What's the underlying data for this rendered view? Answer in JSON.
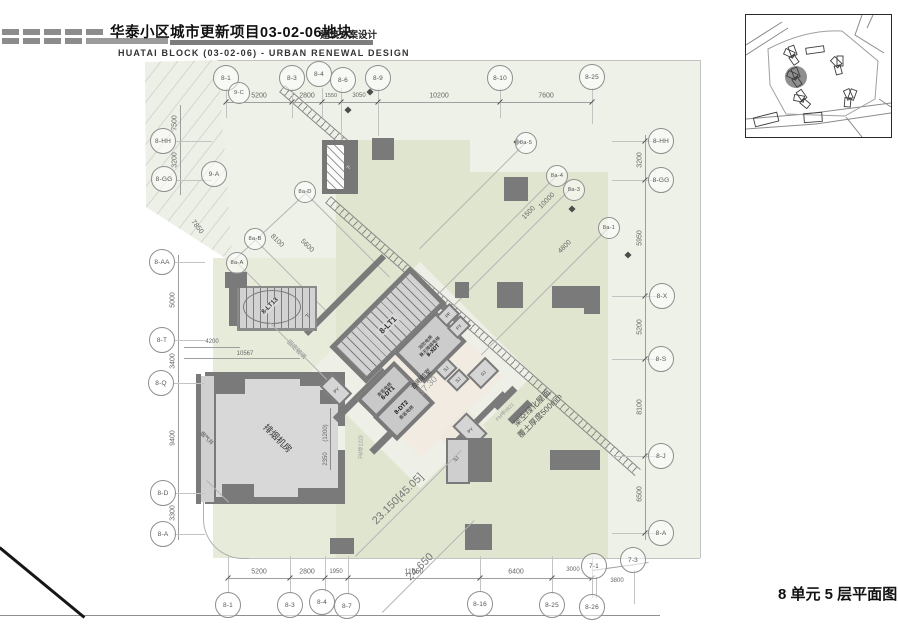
{
  "header": {
    "title": "华泰小区城市更新项目03-02-06地块",
    "subtitle": "建筑方案设计",
    "title_en": "HUATAI BLOCK (03-02-06) - URBAN RENEWAL DESIGN"
  },
  "caption": "8 单元 5 层平面图",
  "colors": {
    "site": "#eef1e7",
    "green_roof": "#dfe5ce",
    "green_light": "#e7ecda",
    "wall": "#7a7a7a",
    "room_fill": "#d8d8d8",
    "beige": "#f1ebe1"
  },
  "grid": {
    "top": [
      "8-1",
      "9-C",
      "8-3",
      "8-4",
      "8-6",
      "8-9",
      "8-10",
      "8-25"
    ],
    "bottom": [
      "8-1",
      "8-3",
      "8-4",
      "8-7",
      "8-16",
      "8-25",
      "8-26",
      "7-1",
      "7-3"
    ],
    "left": [
      "8-HH",
      "8-GG",
      "9-A",
      "8-AA",
      "8-T",
      "8-Q",
      "8-D",
      "8-A"
    ],
    "right": [
      "8-HH",
      "8-GG",
      "8-X",
      "8-S",
      "8-J",
      "8-A"
    ],
    "diag": [
      "8a-5",
      "8a-4",
      "8a-3",
      "8a-1",
      "8a-D",
      "8a-B",
      "8a-A"
    ]
  },
  "dims": {
    "top": [
      "5200",
      "2800",
      "1550",
      "3050",
      "10200",
      "7600"
    ],
    "bottom": [
      "5200",
      "2800",
      "1950",
      "11050",
      "6400",
      "3000",
      "3800"
    ],
    "left": [
      "7500",
      "3200",
      "7850",
      "5000",
      "3400",
      "9400",
      "3300"
    ],
    "left_h": [
      "4200",
      "10567"
    ],
    "right": [
      "3200",
      "5950",
      "5200",
      "8100",
      "6500"
    ],
    "diag": [
      "8100",
      "5600",
      "1500",
      "10000",
      "4800"
    ],
    "room": [
      "(1200)",
      "2350"
    ]
  },
  "rooms": {
    "stair_main": "8-LT1",
    "stair_second": "8-LT13",
    "elevator1_type": "乘客电梯",
    "elevator1": "8-DT1",
    "elevator2_type": "乘客电梯",
    "elevator2": "8-DT2",
    "fire_elevator_l1": "消防电梯",
    "fire_elevator_l2": "兼无障碍电梯",
    "fire_elevator": "8-XDT",
    "lobby": "合用前室",
    "lobby_area": "37.30",
    "smoke_room": "排烟机房",
    "smoke_shaft": "烟气井",
    "shaft_sj": "SJ",
    "shaft_py": "PY",
    "shaft_pf": "PF",
    "down": "下",
    "fixed_glass": "固定玻璃",
    "door1": "FM甲1223",
    "door2": "FM甲0821"
  },
  "annotations": {
    "green_roof_l1": "架空绿化屋面",
    "green_roof_l2": "覆土厚度500mm",
    "level_a": "23.150[45.05]",
    "level_b": "24.650"
  }
}
